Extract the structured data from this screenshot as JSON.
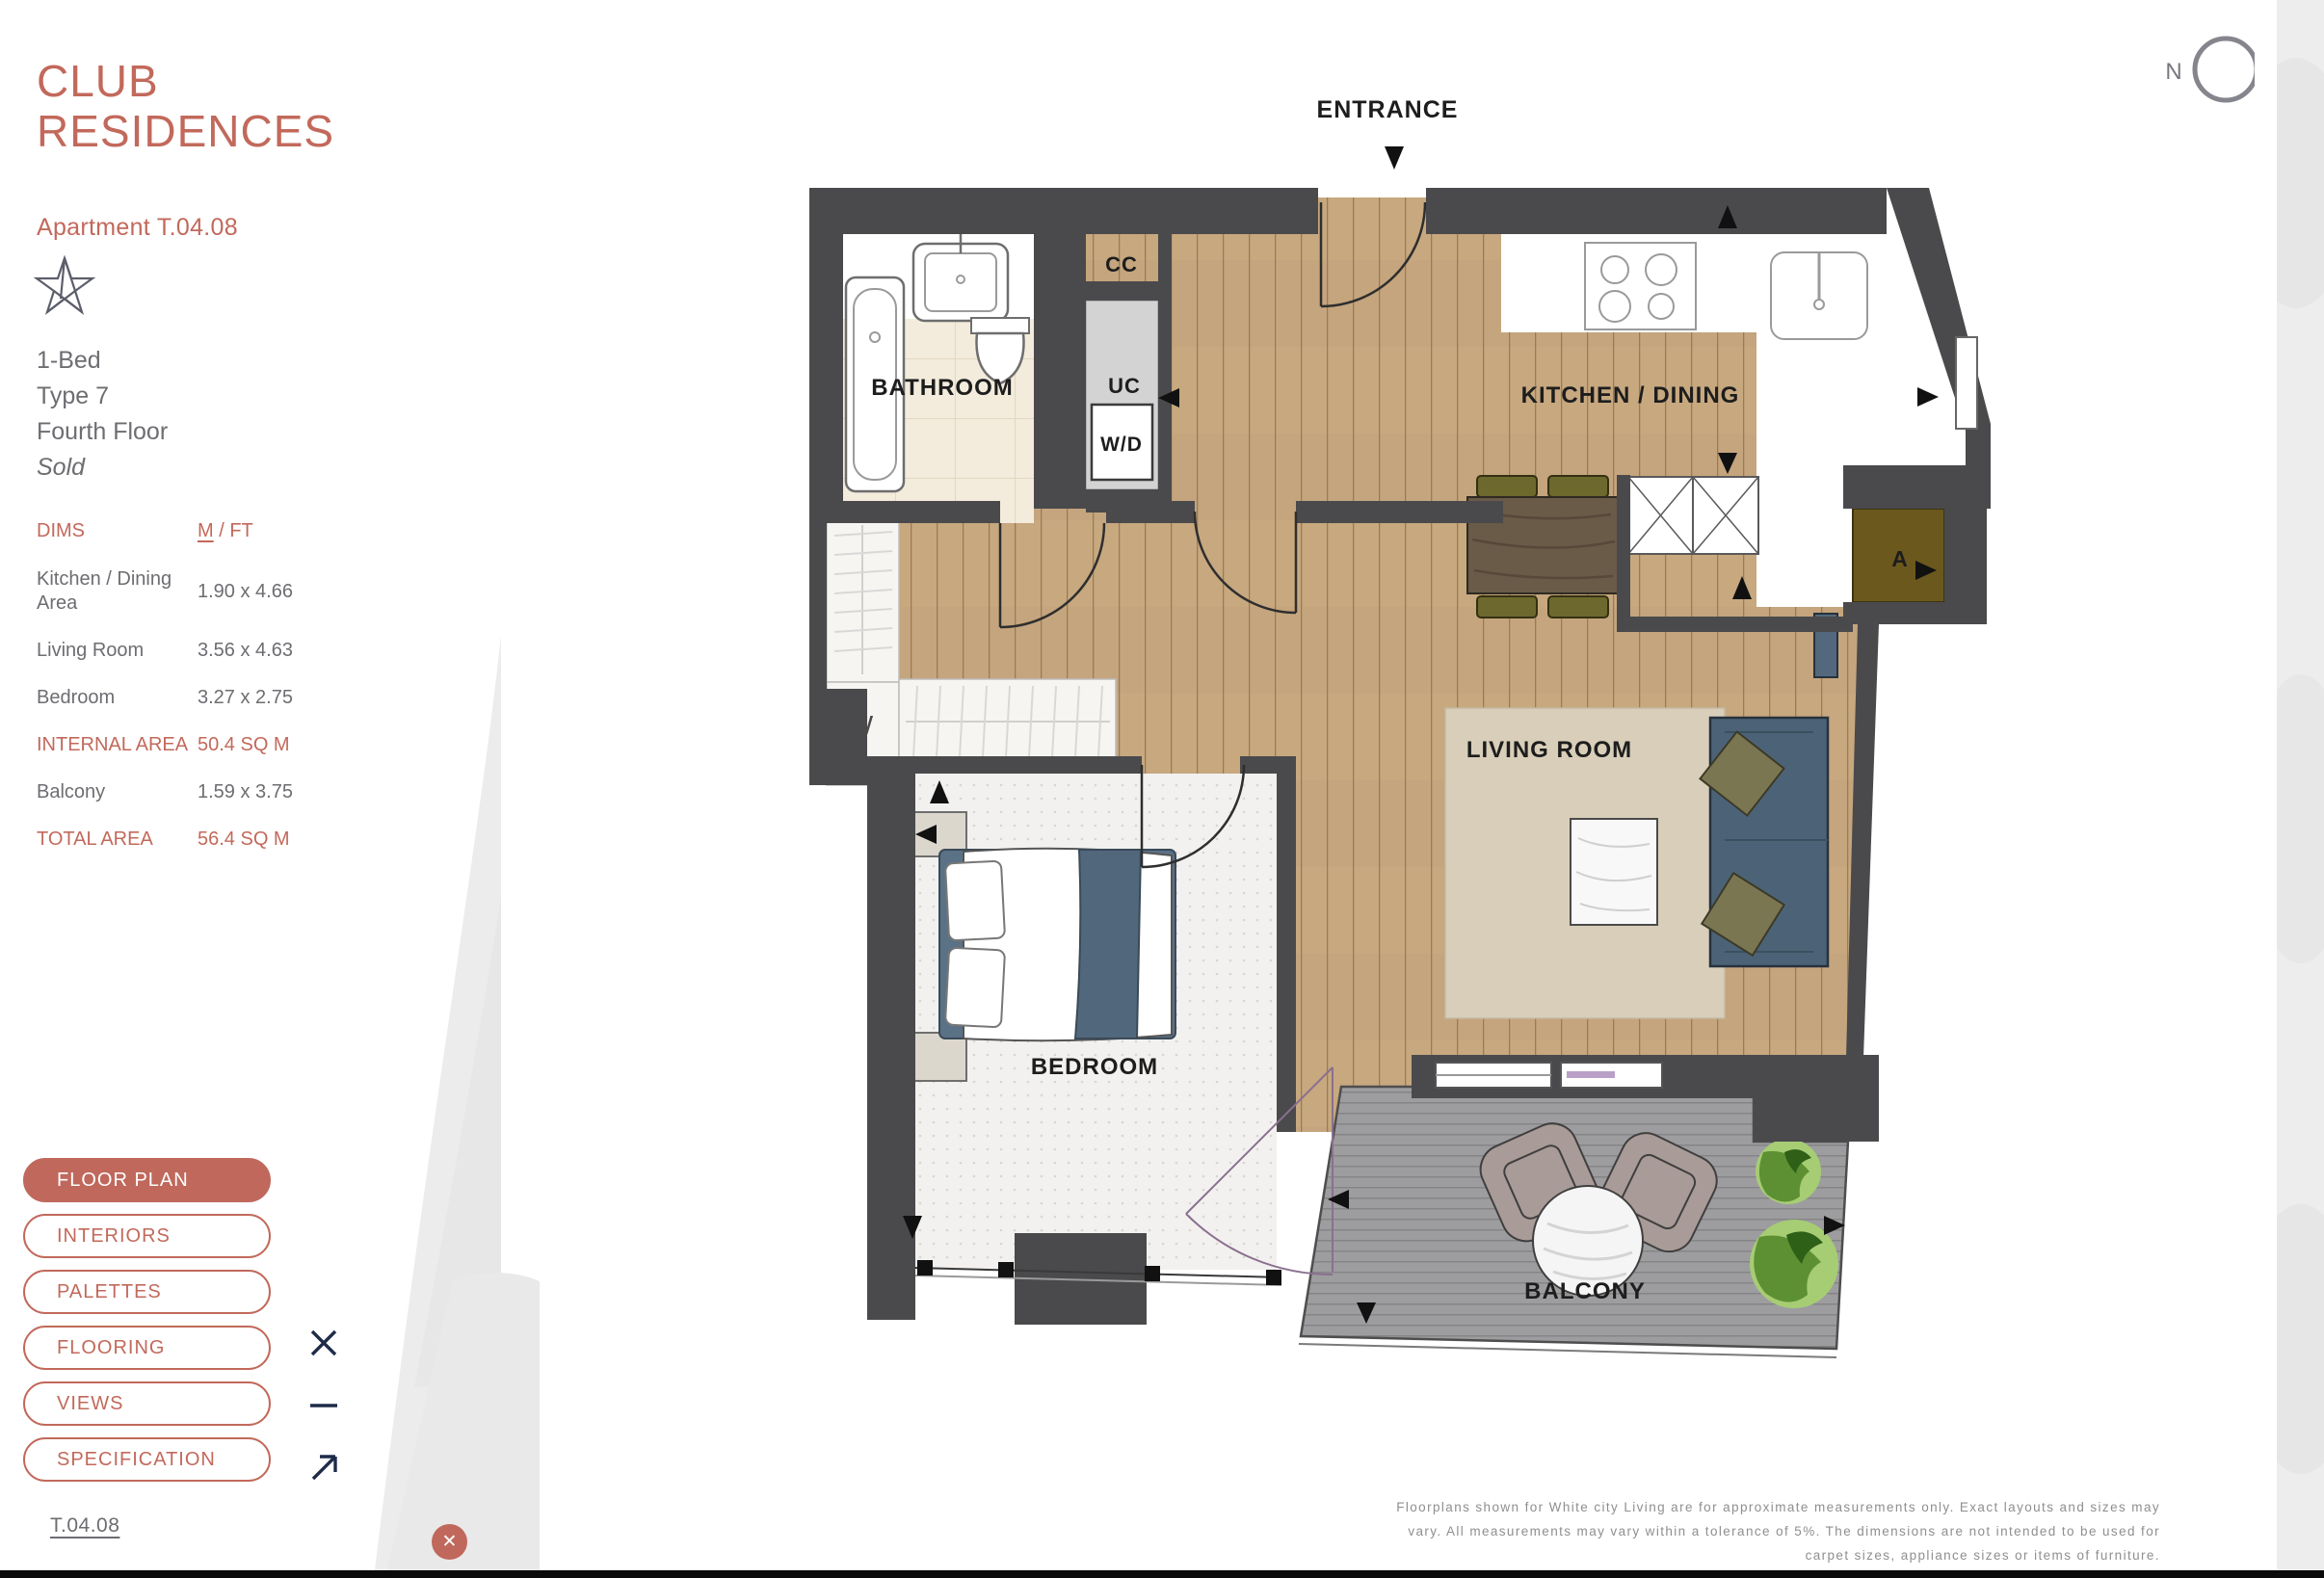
{
  "header": {
    "title_line1": "CLUB",
    "title_line2": "RESIDENCES",
    "apartment": "Apartment T.04.08"
  },
  "info": {
    "beds": "1-Bed",
    "type": "Type 7",
    "floor": "Fourth Floor",
    "status": "Sold"
  },
  "dims": {
    "heading": "DIMS",
    "unit_m": "M",
    "unit_ft": " / FT",
    "rows": [
      {
        "label": "Kitchen / Dining Area",
        "value": "1.90 x 4.66"
      },
      {
        "label": "Living Room",
        "value": "3.56 x 4.63"
      },
      {
        "label": "Bedroom",
        "value": "3.27 x 2.75"
      },
      {
        "label": "INTERNAL AREA",
        "value": "50.4 SQ M"
      },
      {
        "label": "Balcony",
        "value": "1.59 x 3.75"
      },
      {
        "label": "TOTAL AREA",
        "value": "56.4 SQ M"
      }
    ]
  },
  "nav": {
    "floor_plan": "FLOOR PLAN",
    "interiors": "INTERIORS",
    "palettes": "PALETTES",
    "flooring": "FLOORING",
    "views": "VIEWS",
    "specification": "SPECIFICATION"
  },
  "footer": {
    "apartment_code": "T.04.08",
    "close_glyph": "✕"
  },
  "disclaimer": {
    "line1": "Floorplans shown for White city Living are for approximate measurements only. Exact layouts and sizes may",
    "line2": "vary. All measurements may vary within a tolerance of 5%. The dimensions are not intended to be used for",
    "line3": "carpet sizes, appliance sizes or items of furniture."
  },
  "plan": {
    "labels": {
      "entrance": "ENTRANCE",
      "bathroom": "BATHROOM",
      "cc": "CC",
      "uc": "UC",
      "washer_dryer": "W/D",
      "kitchen_dining": "KITCHEN / DINING",
      "living_room": "LIVING ROOM",
      "bedroom": "BEDROOM",
      "balcony": "BALCONY",
      "wardrobe": "W",
      "av_unit": "A",
      "compass_north": "N"
    }
  },
  "colors": {
    "accent": "#c0685c",
    "wall": "#4a4a4c",
    "wood_floor": "#c7a87f",
    "deck": "#9d9d9f",
    "sofa_blue": "#4c6377",
    "icon_navy": "#1e2c49"
  }
}
